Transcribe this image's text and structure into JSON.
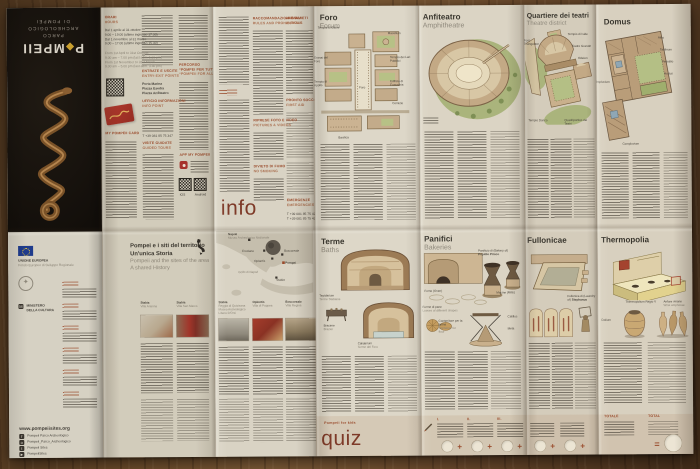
{
  "cover": {
    "logo_p": "P",
    "logo_d": "◆",
    "logo_m": "MPEII",
    "sub1": "PARCO",
    "sub2": "ARCHEOLOGICO",
    "sub3": "DI POMPEI"
  },
  "visit": {
    "orari": "ORARI",
    "hours": "HOURS",
    "h_it": [
      "Dal 1 aprile al 31 ottobre",
      "9.00 – 19.00 (ultimo ingresso 17.30)",
      "Dal 1 novembre al 31 marzo",
      "9.00 – 17.00 (ultimo ingresso 15.30)"
    ],
    "h_en": [
      "From 1st April to 31st October",
      "9.00 am – 7.00 pm (last adm. 5.30 pm)",
      "From 1st November to 31st March",
      "9.00 am – 5.00 pm (last adm. 3.30 pm)"
    ],
    "card": "MY POMPEII CARD",
    "entrate_it": "ENTRATE E USCITE",
    "entrate_en": "ENTRY-EXIT POINTS",
    "gates": [
      "Porta Marina",
      "Piazza Esedra",
      "Piazza Anfiteatro"
    ],
    "uff_it": "UFFICIO INFORMAZIONI",
    "uff_en": "INFO POINT",
    "phone": "T +39 081 85 75 347",
    "visite_it": "VISITE GUIDATE",
    "visite_en": "GUIDED TOURS",
    "percorso_it1": "PERCORSO",
    "percorso_it2": "“POMPEI PER TUTTI”",
    "percorso_en": "“POMPEII FOR ALL” ROUTE",
    "app": "APP MY POMPEII",
    "ios": "iOS",
    "android": "Android",
    "site": "www.pompeiisites.org"
  },
  "rules": {
    "c2_it": "RACCOMANDAZIONI E DIVIETI",
    "c2_en": "RULES AND PROHIBITIONS",
    "c3_it": "ANIMALI",
    "c3_en": "ANIMALS",
    "foto_it": "RIPRESE FOTO E VIDEO",
    "foto_en": "PICTURES & VIDEOS",
    "fumo_it": "DIVIETO DI FUMO",
    "fumo_en": "NO SMOKING",
    "soccorso_it": "PRONTO SOCCORSO",
    "soccorso_en": "FIRST AID",
    "em_it": "EMERGENZE",
    "em_en": "EMERGENCIES",
    "tel1": "T +39 081 85 75 423 408",
    "tel2": "T +39 081 85 75 423 409",
    "info": "info"
  },
  "foro": {
    "title": "Foro",
    "sub": "Forum",
    "labels": [
      "Tempio di Giove",
      "Macellum",
      "Tempio dei Lari Pubblici",
      "Edificio di Eumachia",
      "Comizio",
      "Basilica",
      "Tempio di Apollo",
      "Granai del Foro",
      "Foro"
    ]
  },
  "anfi": {
    "title": "Anfiteatro",
    "sub": "Amphitheatre"
  },
  "teatri": {
    "title": "Quartiere dei teatri",
    "sub": "Theatre district",
    "labels": [
      "Tempio di Iside",
      "Teatro Grande",
      "Odeion",
      "Foro Triangolare",
      "Quadriportico dei Teatri",
      "Tempio Dorico"
    ]
  },
  "domus": {
    "title": "Domus",
    "labels": [
      "Atrio",
      "Tablinum",
      "Peristilio",
      "Hortus",
      "Impluvium",
      "Compluvium"
    ]
  },
  "terr": {
    "it1": "Pompei e i siti del territorio",
    "it2": "Un'unica Storia",
    "en1": "Pompeii and the sites of the area",
    "en2": "A shared History"
  },
  "map": {
    "napoli": "Napoli",
    "museo": "Museo Archeologico Nazionale",
    "ercolano": "Ercolano",
    "oplontis": "Oplontis",
    "boscoreale": "Boscoreale",
    "pompei": "Pompei",
    "stabia": "Stabia",
    "golfo": "Golfo di Napoli"
  },
  "thumbs": [
    {
      "place": "Stabia",
      "name": "Villa Arianna"
    },
    {
      "place": "Stabia",
      "name": "Villa San Marco"
    },
    {
      "place": "Stabia",
      "name": "Reggia di Quisisana Museo Archeologico Libero D'Orsi"
    },
    {
      "place": "Oplontis",
      "name": "Villa di Poppea"
    },
    {
      "place": "Boscoreale",
      "name": "Villa Regina"
    }
  ],
  "terme": {
    "title": "Terme",
    "sub": "Baths",
    "l1a": "Tepidarium",
    "l1b": "Terme Stabiane",
    "l2a": "Braciere",
    "l2b": "Brazier",
    "l3a": "Calidarium",
    "l3b": "Terme del Foro"
  },
  "panifici": {
    "title": "Panifici",
    "sub": "Bakeries",
    "bakery1": "Panificio di (Bakery of)",
    "bakery2": "Popidio Prisco",
    "forno": "Forno (Oven)",
    "macine": "Macine (Mills)",
    "pane1": "Forme di pane",
    "pane2": "Loaves of different shapes",
    "catillus": "Catillus",
    "meta": "Meta",
    "flour1": "Contenitore per la farina",
    "flour2": "Container for flour"
  },
  "full": {
    "title": "Fullonicae",
    "l1": "Fullonica di (Laundry of)",
    "l2": "Stephanus"
  },
  "thermo": {
    "title": "Thermopolia",
    "counter": "Thermopolium Regio V",
    "dolium": "Dolium",
    "anfore1": "Anfore vinarie",
    "anfore2": "Wine amphorae"
  },
  "kids": {
    "label": "Pompeii for kids",
    "quiz": "quiz",
    "n1": "I.",
    "n2": "II.",
    "n3": "III.",
    "plus": "+",
    "eq": "=",
    "totale": "TOTALE",
    "total": "TOTAL"
  },
  "credits": {
    "eu1": "UNIONE EUROPEA",
    "eu2": "Fondo Europeo di Sviluppo Regionale",
    "min1": "MINISTERO",
    "min2": "DELLA CULTURA",
    "site": "www.pompeiisites.org",
    "soc": [
      "Pompeii Parco Archeologico",
      "Pompeii_Parco_Archeologico",
      "Pompeii Sites",
      "PompeiiSites"
    ]
  }
}
